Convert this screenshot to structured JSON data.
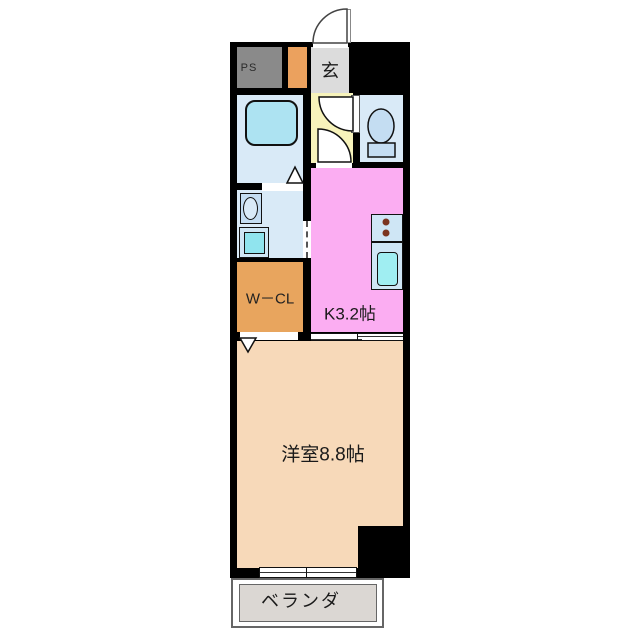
{
  "title": "1K apartment floor plan",
  "rooms": {
    "ps": {
      "label": "PS"
    },
    "genkan": {
      "label": "玄"
    },
    "wcl": {
      "label": "W－CL"
    },
    "kitchen": {
      "label": "K3.2帖"
    },
    "main_room": {
      "label": "洋室8.8帖"
    },
    "veranda": {
      "label": "ベランダ"
    }
  },
  "icons": {
    "entrance_door": "quarter-circle door swing",
    "toilet": "toilet bowl",
    "bathtub": "bathtub",
    "stove": "two-burner stove",
    "kitchen_sink": "kitchen sink",
    "wash_basin": "wash basin",
    "washing_machine": "washing machine pan",
    "door_triangles": "folding door markers",
    "sliding_doors": "sliding door / window symbols"
  },
  "colors": {
    "wall": "#000000",
    "ps": "#8a8a8a",
    "step": "#eba15e",
    "genkan": "#dcdcdc",
    "hall": "#f7f3bb",
    "water": "#d9eaf7",
    "tub": "#ade3f2",
    "kitchen": "#fbadf2",
    "counter": "#cfe6f5",
    "sink": "#a0eef2",
    "burner": "#7b3520",
    "washer": "#90e4ee",
    "wcl": "#e8a55e",
    "room": "#f7d9b9",
    "veranda": "#dbd7d3",
    "fixture": "#c4ddf2"
  }
}
